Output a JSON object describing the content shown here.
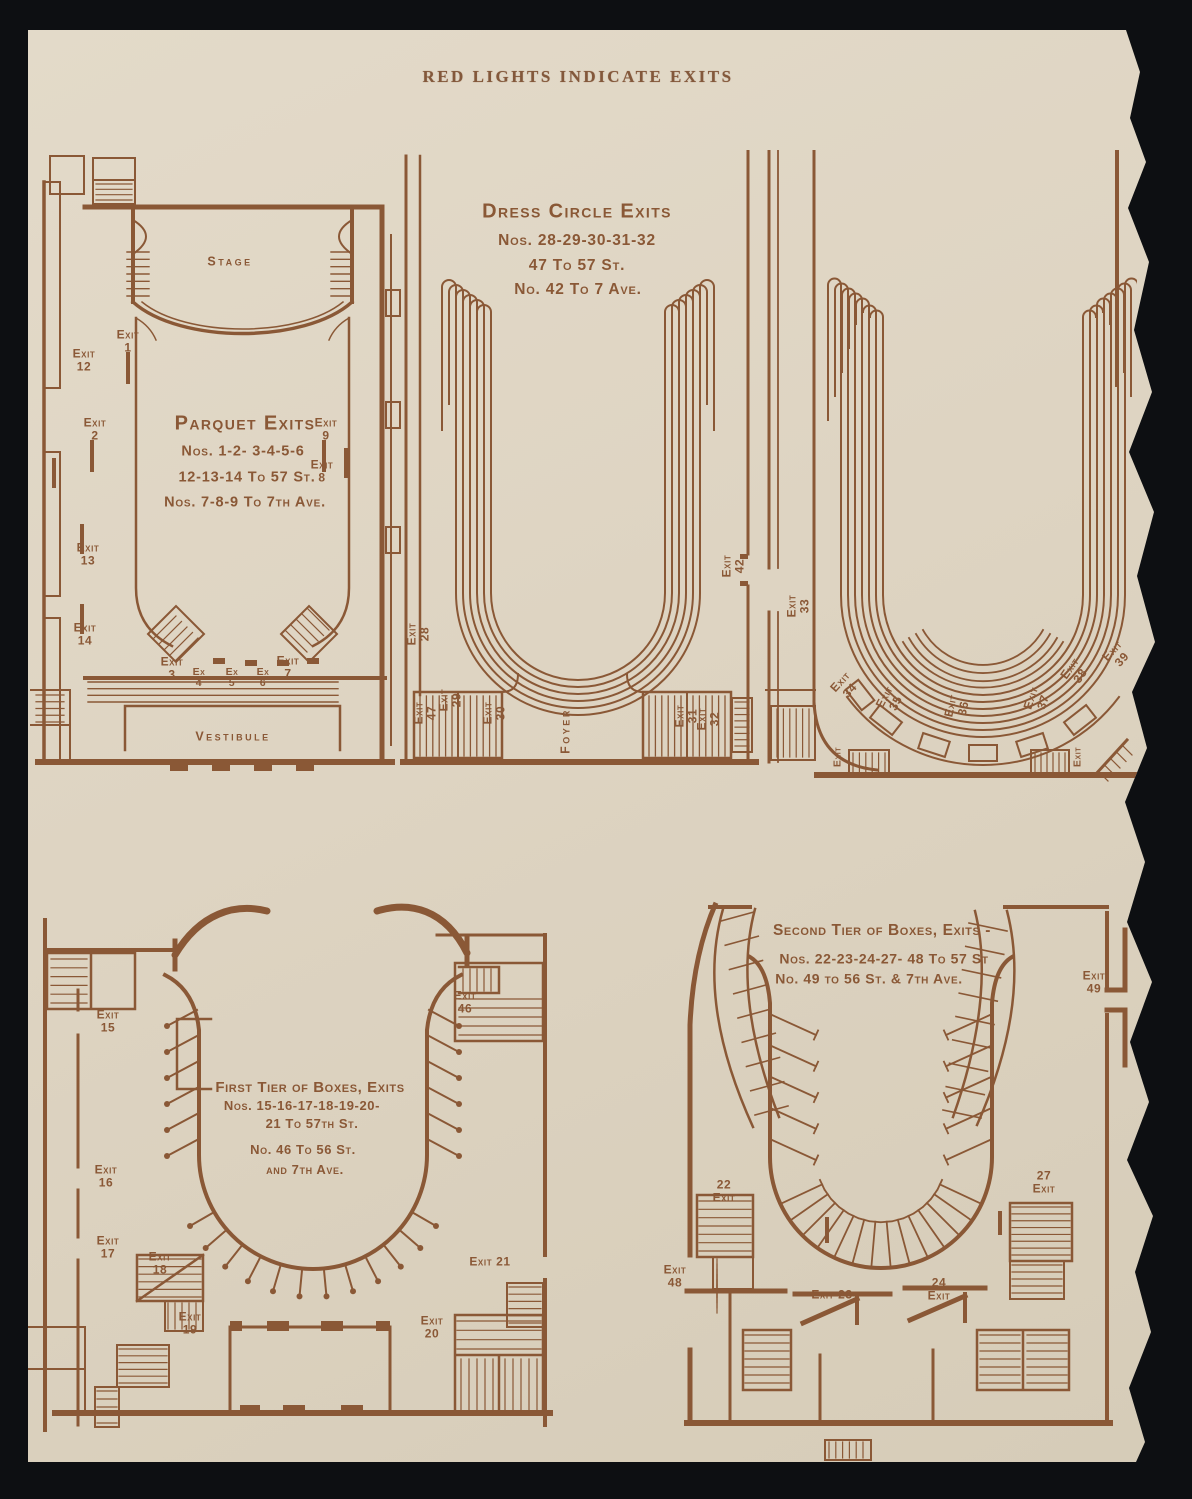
{
  "palette": {
    "ink": "#8a5836",
    "paper": "#ded4c2",
    "background": "#0d0f12"
  },
  "header": {
    "title": "RED LIGHTS INDICATE EXITS"
  },
  "parquet": {
    "title": "Parquet Exits",
    "line1": "Nos. 1-2- 3-4-5-6",
    "line2": "12-13-14 To 57 St.",
    "line3": "Nos. 7-8-9 To 7th Ave.",
    "stage": "Stage",
    "vestibule": "Vestibule",
    "exits": {
      "e1": "Exit\n1",
      "e2": "Exit\n2",
      "e3": "Exit\n3",
      "e4": "Ex\n4",
      "e5": "Ex\n5",
      "e6": "Ex\n6",
      "e7": "Exit\n7",
      "e8": "Exit\n8",
      "e9": "Exit\n9",
      "e12": "Exit\n12",
      "e13": "Exit\n13",
      "e14": "Exit\n14"
    }
  },
  "dress_circle": {
    "title": "Dress Circle Exits",
    "line1": "Nos. 28-29-30-31-32",
    "line2": "47 To 57 St.",
    "line3": "No. 42 To 7 Ave.",
    "foyer": "Foyer",
    "exits": {
      "e28": "Exit\n28",
      "e29": "Exit\n29",
      "e30": "Exit\n30",
      "e31": "Exit\n31",
      "e32": "Exit\n32",
      "e42": "Exit\n42",
      "e47": "Exit\n47"
    }
  },
  "balcony": {
    "exits": {
      "e33": "Exit\n33",
      "e34": "Exit\n34",
      "e35": "Exit\n35",
      "e36": "Exit\n36",
      "e37": "Exit\n37",
      "e38": "Exit\n38",
      "e39": "Exit\n39",
      "sw": "Exit",
      "se": "Exit"
    }
  },
  "first_tier": {
    "title": "First Tier of Boxes, Exits",
    "line1": "Nos. 15-16-17-18-19-20-",
    "line2": "21 To 57th St.",
    "line3": "No. 46 To 56 St.",
    "line4": "and 7th Ave.",
    "exits": {
      "e15": "Exit\n15",
      "e16": "Exit\n16",
      "e17": "Exit\n17",
      "e18": "Exit\n18",
      "e19": "Exit\n19",
      "e20": "Exit\n20",
      "e21": "Exit 21",
      "e46": "Exit\n46"
    }
  },
  "second_tier": {
    "title": "Second Tier of Boxes, Exits -",
    "line1": "Nos. 22-23-24-27- 48 To 57 St",
    "line2": "No. 49 to 56 St. & 7th Ave.",
    "exits": {
      "e22": "22\nExit",
      "e23": "Exit 23",
      "e24": "24\nExit",
      "e27": "27\nExit",
      "e48": "Exit\n48",
      "e49": "Exit\n49"
    }
  }
}
